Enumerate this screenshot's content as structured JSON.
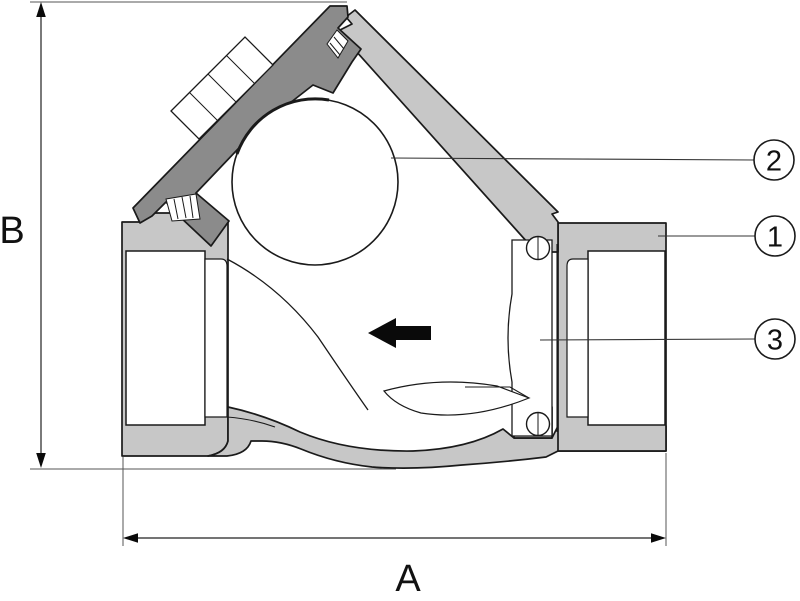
{
  "diagram": {
    "kind": "check-valve-cross-section",
    "dimensions": {
      "horizontal": {
        "label": "A"
      },
      "vertical": {
        "label": "B"
      }
    },
    "callouts": [
      {
        "number": "2",
        "target": "ball"
      },
      {
        "number": "1",
        "target": "valve-body"
      },
      {
        "number": "3",
        "target": "seat-insert"
      }
    ],
    "flow_arrow": {
      "direction": "left"
    },
    "colors": {
      "background": "#ffffff",
      "body_fill": "#c7c7c7",
      "cap_fill": "#8b8b8b",
      "outline": "#1a1a1a",
      "thin_line": "#444444",
      "arrow_black": "#0a0a0a"
    }
  }
}
